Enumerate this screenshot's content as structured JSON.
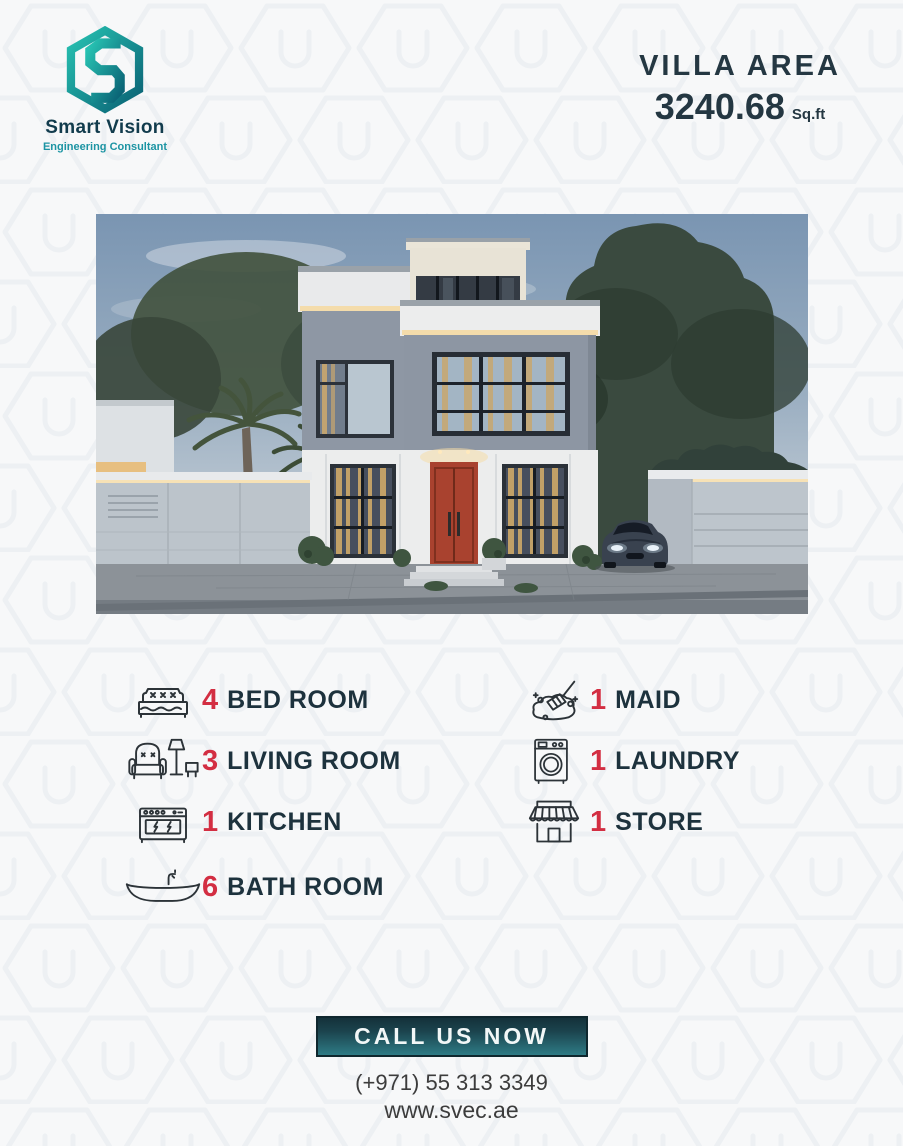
{
  "brand": {
    "name": "Smart Vision",
    "tagline": "Engineering Consultant",
    "logo_icon": "hexagon-s-icon",
    "colors": {
      "teal": "#1c94a3",
      "teal_dark": "#0a6174",
      "navy": "#123c4d"
    }
  },
  "villa_area": {
    "label": "VILLA AREA",
    "value": "3240.68",
    "unit": "Sq.ft"
  },
  "features": {
    "left": [
      {
        "icon": "bed-icon",
        "count": "4",
        "label": "BED ROOM"
      },
      {
        "icon": "living-room-icon",
        "count": "3",
        "label": "LIVING ROOM"
      },
      {
        "icon": "kitchen-icon",
        "count": "1",
        "label": "KITCHEN"
      },
      {
        "icon": "bathtub-icon",
        "count": "6",
        "label": "BATH ROOM"
      }
    ],
    "right": [
      {
        "icon": "maid-icon",
        "count": "1",
        "label": "MAID"
      },
      {
        "icon": "laundry-icon",
        "count": "1",
        "label": "LAUNDRY"
      },
      {
        "icon": "store-icon",
        "count": "1",
        "label": "STORE"
      }
    ]
  },
  "cta": {
    "button_label": "CALL US NOW",
    "phone": "(+971) 55 313 3349",
    "website": "www.svec.ae"
  },
  "theme": {
    "background": "#f7f8f9",
    "pattern_stroke": "#edf0f3",
    "text_dark": "#1d323d",
    "number_red": "#d32e42",
    "button_gradient_top": "#14313a",
    "button_gradient_bottom": "#2e7b85"
  }
}
